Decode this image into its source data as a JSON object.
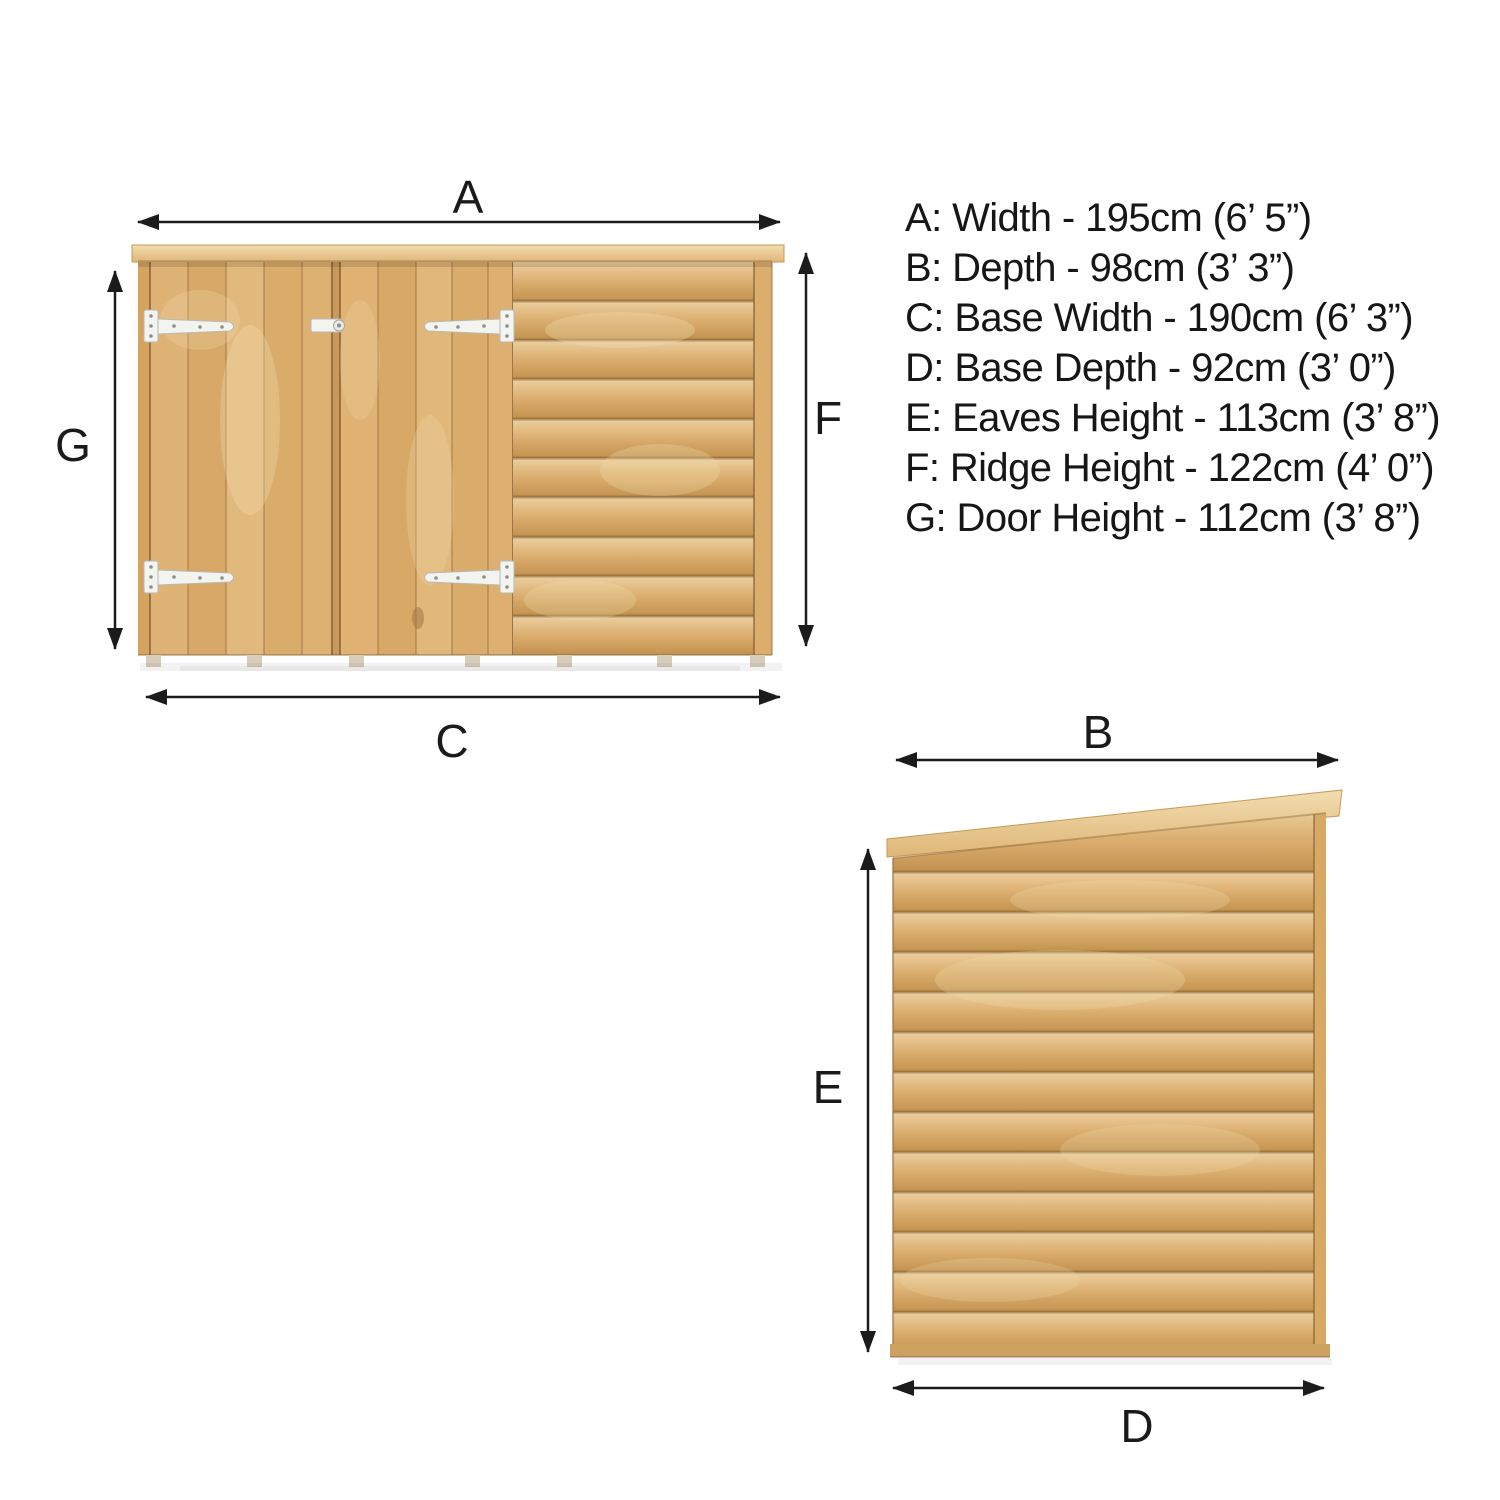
{
  "page": {
    "background": "#ffffff",
    "text_color": "#161616"
  },
  "colors": {
    "arrow": "#1b1b1b",
    "wood_light": "#ecd29c",
    "wood_mid": "#ddb173",
    "wood_dark": "#c2914e",
    "seam_shadow": "#8a6233",
    "roof_light": "#f2ddae",
    "hinge_metal": "#f3f3f0"
  },
  "front_view": {
    "description": "front elevation of wooden pent shed with double doors and overlap cladding",
    "top_label": "A",
    "left_label": "G",
    "right_label": "F",
    "bottom_label": "C"
  },
  "side_view": {
    "description": "side elevation of wooden pent shed with overlap cladding",
    "top_label": "B",
    "left_label": "E",
    "bottom_label": "D"
  },
  "dimensions": {
    "items": [
      {
        "key": "A",
        "name": "Width",
        "metric": "195cm",
        "imperial": "6’ 5”",
        "full": "A: Width - 195cm (6’ 5”)"
      },
      {
        "key": "B",
        "name": "Depth",
        "metric": "98cm",
        "imperial": "3’ 3”",
        "full": "B: Depth - 98cm (3’ 3”)"
      },
      {
        "key": "C",
        "name": "Base Width",
        "metric": "190cm",
        "imperial": "6’ 3”",
        "full": "C: Base Width - 190cm (6’ 3”)"
      },
      {
        "key": "D",
        "name": "Base Depth",
        "metric": "92cm",
        "imperial": "3’ 0”",
        "full": "D: Base Depth - 92cm (3’ 0”)"
      },
      {
        "key": "E",
        "name": "Eaves Height",
        "metric": "113cm",
        "imperial": "3’ 8”",
        "full": "E: Eaves Height - 113cm (3’ 8”)"
      },
      {
        "key": "F",
        "name": "Ridge Height",
        "metric": "122cm",
        "imperial": "4’ 0”",
        "full": "F: Ridge Height - 122cm (4’ 0”)"
      },
      {
        "key": "G",
        "name": "Door Height",
        "metric": "112cm",
        "imperial": "3’ 8”",
        "full": "G: Door Height - 112cm (3’ 8”)"
      }
    ]
  }
}
